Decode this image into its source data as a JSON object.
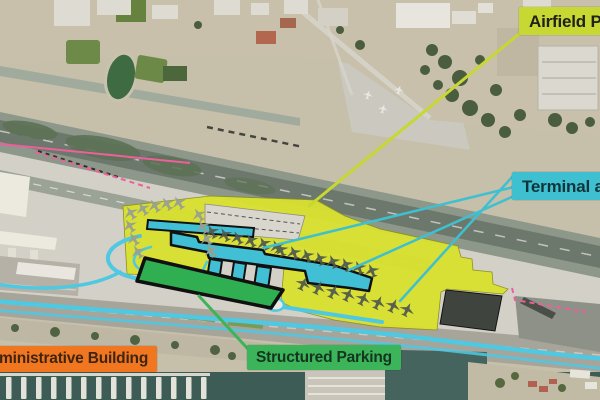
{
  "figure": {
    "type": "annotated-aerial-plan",
    "description_visible_elements": "satellite aerial view of an airport with colored plan overlays and four callout labels"
  },
  "labels": {
    "airfield": {
      "text": "Airfield Pa",
      "bg": "#c6d831",
      "color": "#20211a"
    },
    "terminal": {
      "text": "Terminal an",
      "bg": "#3ec0d0",
      "color": "#11343a"
    },
    "admin": {
      "text": "ministrative Building",
      "bg": "#f0761f",
      "color": "#3d2511"
    },
    "parking": {
      "text": "Structured Parking",
      "bg": "#3bb45a",
      "color": "#15351f"
    }
  },
  "overlay_colors": {
    "airfield_pavement": "#d9e030",
    "terminal_building": "#41c0d5",
    "structured_parking": "#2fae52",
    "roads": "#4fc8e2",
    "leader_airfield": "#c6d831",
    "leader_terminal": "#3ec0d0",
    "leader_parking": "#3bb45a",
    "boundary_dashed_pink": "#ee5f9d",
    "outline_black": "#101010"
  },
  "icons": {
    "airplane": "airplane-icon"
  }
}
